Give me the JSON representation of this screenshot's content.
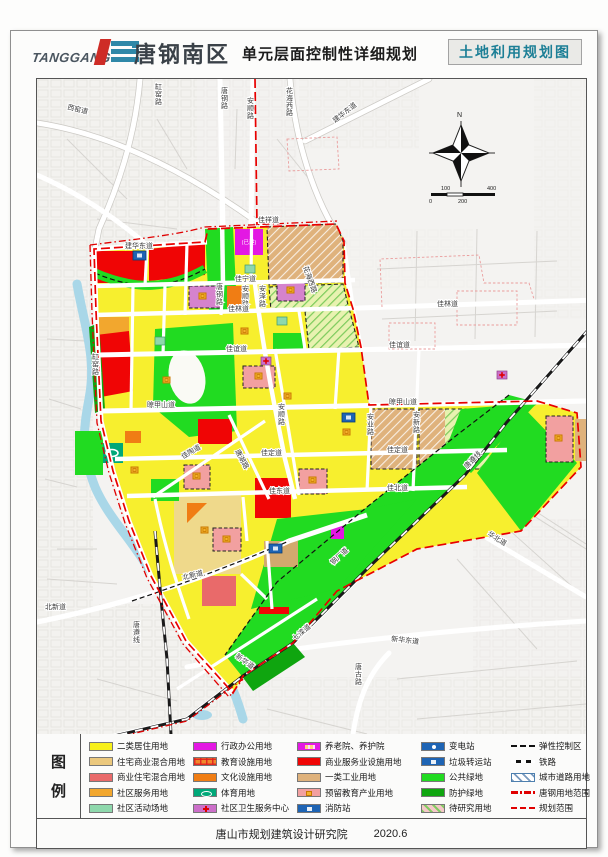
{
  "header": {
    "logo_text": "TANGGANG",
    "title": "唐钢南区",
    "subtitle": "单元层面控制性详细规划",
    "map_type_label": "土地利用规划图"
  },
  "map": {
    "compass_label": "N",
    "scale_ticks": [
      "0",
      "100",
      "200",
      "400"
    ],
    "built_note": "(已建)",
    "road_labels": [
      {
        "t": "西窑道",
        "x": 30,
        "y": 30,
        "r": 14
      },
      {
        "t": "缸窑路",
        "x": 118,
        "y": 10,
        "v": 1
      },
      {
        "t": "唐钢路",
        "x": 184,
        "y": 14,
        "v": 1
      },
      {
        "t": "安顺路",
        "x": 210,
        "y": 24,
        "v": 1
      },
      {
        "t": "花海西路",
        "x": 249,
        "y": 14,
        "v": 1
      },
      {
        "t": "建华东道",
        "x": 298,
        "y": 44,
        "r": -38
      },
      {
        "t": "佳祥道",
        "x": 221,
        "y": 143
      },
      {
        "t": "花海西路",
        "x": 266,
        "y": 188,
        "r": 70
      },
      {
        "t": "建华东道",
        "x": 88,
        "y": 169
      },
      {
        "t": "佳宁道",
        "x": 198,
        "y": 202
      },
      {
        "t": "唐钢路",
        "x": 179,
        "y": 210,
        "v": 1
      },
      {
        "t": "安顺路",
        "x": 205,
        "y": 212,
        "v": 1
      },
      {
        "t": "安泽路",
        "x": 222,
        "y": 212,
        "v": 1
      },
      {
        "t": "缸窑路",
        "x": 55,
        "y": 280,
        "v": 1
      },
      {
        "t": "佳林道",
        "x": 191,
        "y": 232
      },
      {
        "t": "佳林道",
        "x": 400,
        "y": 227
      },
      {
        "t": "佳谊道",
        "x": 189,
        "y": 272
      },
      {
        "t": "佳谊道",
        "x": 352,
        "y": 268
      },
      {
        "t": "晾甲山道",
        "x": 110,
        "y": 328
      },
      {
        "t": "晾甲山道",
        "x": 352,
        "y": 325
      },
      {
        "t": "安业路",
        "x": 330,
        "y": 340,
        "v": 1
      },
      {
        "t": "安新路",
        "x": 376,
        "y": 338,
        "v": 1
      },
      {
        "t": "安顺路",
        "x": 241,
        "y": 330,
        "v": 1
      },
      {
        "t": "佳定道",
        "x": 224,
        "y": 376
      },
      {
        "t": "佳定道",
        "x": 350,
        "y": 373
      },
      {
        "t": "佳陶道",
        "x": 146,
        "y": 380,
        "r": -30
      },
      {
        "t": "唐湖路",
        "x": 198,
        "y": 372,
        "r": 62
      },
      {
        "t": "佳东道",
        "x": 232,
        "y": 414
      },
      {
        "t": "佳北道",
        "x": 350,
        "y": 411
      },
      {
        "t": "北新道",
        "x": 146,
        "y": 501,
        "r": -14
      },
      {
        "t": "北新道",
        "x": 8,
        "y": 530
      },
      {
        "t": "唐遵线",
        "x": 96,
        "y": 548,
        "v": 1
      },
      {
        "t": "新华道",
        "x": 198,
        "y": 578,
        "r": 36
      },
      {
        "t": "七滦道",
        "x": 258,
        "y": 562,
        "r": -40
      },
      {
        "t": "新华东道",
        "x": 354,
        "y": 562,
        "r": 6
      },
      {
        "t": "华北道",
        "x": 450,
        "y": 456,
        "r": 32
      },
      {
        "t": "唐古路",
        "x": 318,
        "y": 590,
        "v": 1
      },
      {
        "t": "唐遵线",
        "x": 430,
        "y": 390,
        "r": -46
      },
      {
        "t": "钢厂道",
        "x": 296,
        "y": 486,
        "r": -42
      }
    ]
  },
  "legend": {
    "title_chars": [
      "图",
      "例"
    ],
    "columns": [
      [
        {
          "label": "二类居住用地",
          "type": "solid",
          "color": "#F7F01A"
        },
        {
          "label": "住宅商业混合用地",
          "type": "solid",
          "color": "#EBC87D"
        },
        {
          "label": "商业住宅混合用地",
          "type": "solid",
          "color": "#E96A6A"
        },
        {
          "label": "社区服务用地",
          "type": "solid",
          "color": "#F2A72E"
        },
        {
          "label": "社区活动场地",
          "type": "solid",
          "color": "#8ED8AC"
        }
      ],
      [
        {
          "label": "行政办公用地",
          "type": "solid",
          "color": "#E318E3"
        },
        {
          "label": "教育设施用地",
          "type": "edu",
          "color": "#F0882A"
        },
        {
          "label": "文化设施用地",
          "type": "solid",
          "color": "#F07D14"
        },
        {
          "label": "体育用地",
          "type": "sport",
          "color": "#00A878"
        },
        {
          "label": "社区卫生服务中心",
          "type": "health",
          "color": "#CC6FC9"
        }
      ],
      [
        {
          "label": "养老院、养护院",
          "type": "elder",
          "color": "#E318E3"
        },
        {
          "label": "商业服务业设施用地",
          "type": "solid",
          "color": "#F00505"
        },
        {
          "label": "一类工业用地",
          "type": "solid",
          "color": "#DFB27C"
        },
        {
          "label": "预留教育产业用地",
          "type": "reserve",
          "color": "#F2A0A0"
        },
        {
          "label": "消防站",
          "type": "station-sq",
          "color": "#1E64B4"
        }
      ],
      [
        {
          "label": "变电站",
          "type": "station-dot",
          "color": "#1E64B4"
        },
        {
          "label": "垃圾转运站",
          "type": "station-sq",
          "color": "#1E64B4"
        },
        {
          "label": "公共绿地",
          "type": "solid",
          "color": "#21DB21"
        },
        {
          "label": "防护绿地",
          "type": "solid",
          "color": "#0FA50F"
        },
        {
          "label": "待研究用地",
          "type": "study",
          "color": "#F5C8C8"
        }
      ],
      [
        {
          "label": "弹性控制区",
          "type": "line-dash-black"
        },
        {
          "label": "铁路",
          "type": "line-railway"
        },
        {
          "label": "城市道路用地",
          "type": "road-hatch"
        },
        {
          "label": "唐钢用地范围",
          "type": "line-dashdot-red",
          "color": "#E00000"
        },
        {
          "label": "规划范围",
          "type": "line-dash-red",
          "color": "#E00000"
        }
      ]
    ]
  },
  "footer": {
    "org": "唐山市规划建筑设计研究院",
    "date": "2020.6"
  },
  "colors": {
    "boundary_red": "#E80000",
    "railway_black": "#1A1A1A",
    "river_blue": "#A9D7E8",
    "accent_teal": "#1C7F96",
    "logo_red": "#CE2C26",
    "logo_teal": "#2F88A8"
  }
}
